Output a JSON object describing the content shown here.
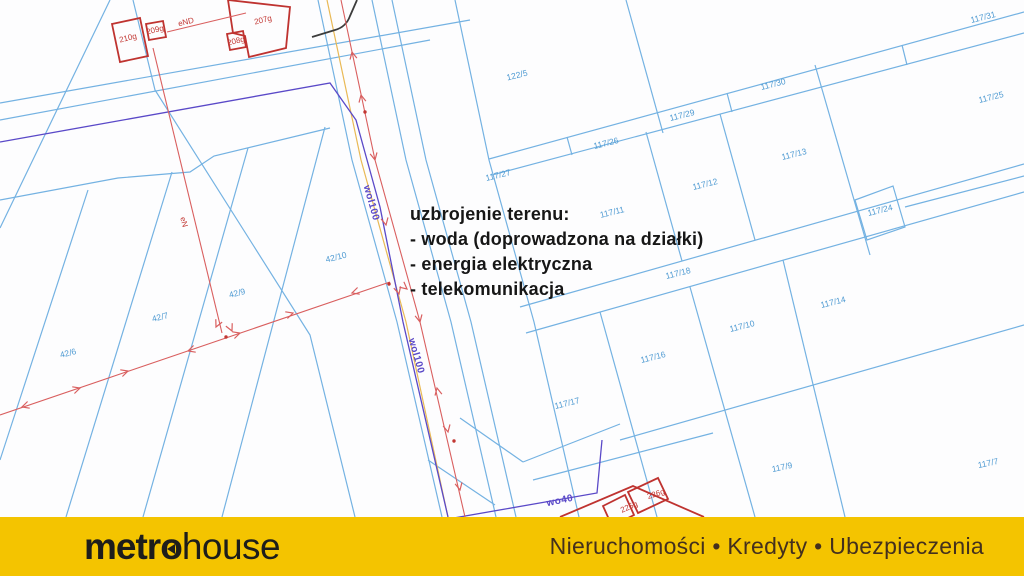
{
  "map": {
    "annotation": {
      "title": "uzbrojenie terenu:",
      "items": [
        "- woda (doprowadzona na działki)",
        "- energia elektryczna",
        "- telekomunikacja"
      ]
    },
    "labels": [
      {
        "text": "122/5",
        "x": 517,
        "y": 75,
        "r": -14,
        "t": "p"
      },
      {
        "text": "117/31",
        "x": 983,
        "y": 17,
        "r": -14,
        "t": "p"
      },
      {
        "text": "117/30",
        "x": 773,
        "y": 84,
        "r": -14,
        "t": "p"
      },
      {
        "text": "117/25",
        "x": 991,
        "y": 97,
        "r": -14,
        "t": "p"
      },
      {
        "text": "117/29",
        "x": 682,
        "y": 115,
        "r": -14,
        "t": "p"
      },
      {
        "text": "117/26",
        "x": 606,
        "y": 143,
        "r": -14,
        "t": "p"
      },
      {
        "text": "117/13",
        "x": 794,
        "y": 154,
        "r": -14,
        "t": "p"
      },
      {
        "text": "117/27",
        "x": 498,
        "y": 175,
        "r": -14,
        "t": "p"
      },
      {
        "text": "117/12",
        "x": 705,
        "y": 184,
        "r": -14,
        "t": "p"
      },
      {
        "text": "117/24",
        "x": 880,
        "y": 210,
        "r": -14,
        "t": "p"
      },
      {
        "text": "117/11",
        "x": 612,
        "y": 212,
        "r": -14,
        "t": "p"
      },
      {
        "text": "117/18",
        "x": 678,
        "y": 273,
        "r": -14,
        "t": "p"
      },
      {
        "text": "117/14",
        "x": 833,
        "y": 302,
        "r": -14,
        "t": "p"
      },
      {
        "text": "117/10",
        "x": 742,
        "y": 326,
        "r": -14,
        "t": "p"
      },
      {
        "text": "117/16",
        "x": 653,
        "y": 357,
        "r": -14,
        "t": "p"
      },
      {
        "text": "117/17",
        "x": 567,
        "y": 403,
        "r": -14,
        "t": "p"
      },
      {
        "text": "117/9",
        "x": 782,
        "y": 467,
        "r": -12,
        "t": "p"
      },
      {
        "text": "117/7",
        "x": 988,
        "y": 463,
        "r": -12,
        "t": "p"
      },
      {
        "text": "42/10",
        "x": 336,
        "y": 257,
        "r": -14,
        "t": "p"
      },
      {
        "text": "42/9",
        "x": 237,
        "y": 293,
        "r": -14,
        "t": "p"
      },
      {
        "text": "42/7",
        "x": 160,
        "y": 317,
        "r": -14,
        "t": "p"
      },
      {
        "text": "42/6",
        "x": 68,
        "y": 353,
        "r": -14,
        "t": "p"
      },
      {
        "text": "210g",
        "x": 128,
        "y": 38,
        "r": -14,
        "t": "b"
      },
      {
        "text": "209g",
        "x": 155,
        "y": 30,
        "r": -14,
        "t": "b"
      },
      {
        "text": "207g",
        "x": 263,
        "y": 20,
        "r": -14,
        "t": "b"
      },
      {
        "text": "208g",
        "x": 236,
        "y": 41,
        "r": -14,
        "t": "b"
      },
      {
        "text": "eND",
        "x": 186,
        "y": 22,
        "r": -14,
        "t": "b"
      },
      {
        "text": "eN",
        "x": 184,
        "y": 222,
        "r": 75,
        "t": "b"
      },
      {
        "text": "225g",
        "x": 629,
        "y": 507,
        "r": -24,
        "t": "b"
      },
      {
        "text": "226g",
        "x": 656,
        "y": 494,
        "r": -18,
        "t": "b"
      },
      {
        "text": "wol100",
        "x": 371,
        "y": 203,
        "r": 74,
        "t": "u"
      },
      {
        "text": "wol100",
        "x": 416,
        "y": 356,
        "r": 74,
        "t": "u"
      },
      {
        "text": "wo40",
        "x": 560,
        "y": 501,
        "r": -12,
        "t": "u"
      }
    ]
  },
  "footer": {
    "brand_prefix": "metr",
    "brand_o": "o",
    "brand_suffix": "house",
    "tagline": "Nieruchomości • Kredyty • Ubezpieczenia"
  },
  "colors": {
    "parcel_line": "#74b2e2",
    "parcel_text": "#4e9ad2",
    "building": "#bf3330",
    "measure_red": "#d95f5f",
    "utility_purple": "#5a49c8",
    "utility_orange": "#e9b955",
    "banner_yellow": "#f4c400"
  }
}
